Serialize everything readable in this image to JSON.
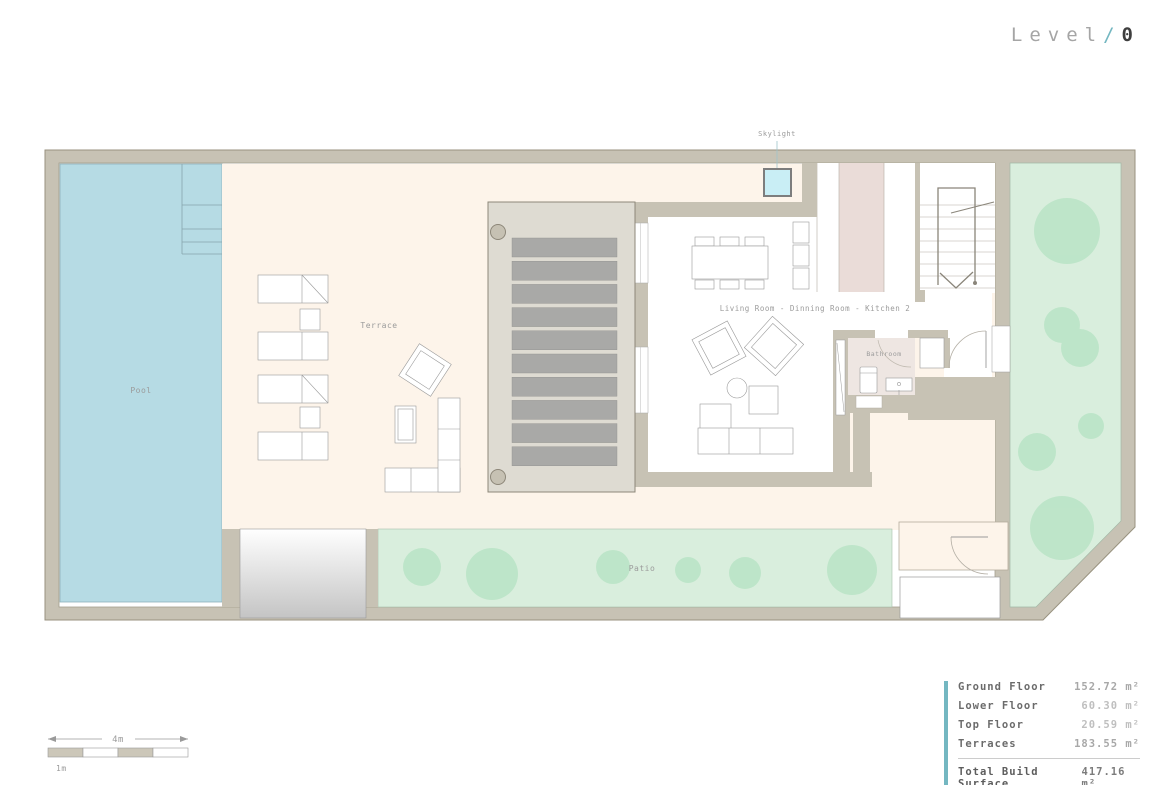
{
  "header": {
    "level_label": "Level",
    "separator": "/",
    "level_number": "0"
  },
  "plan": {
    "labels": {
      "skylight": "Skylight",
      "pool": "Pool",
      "terrace": "Terrace",
      "patio": "Patio",
      "bathroom": "Bathroom",
      "living_area": "Living Room - Dinning Room - Kitchen 2"
    }
  },
  "scale_bar": {
    "total_label": "4m",
    "unit_label": "1m"
  },
  "summary": {
    "rows": [
      {
        "label": "Ground Floor",
        "value": "152.72 m²"
      },
      {
        "label": "Lower Floor",
        "value": "60.30 m²"
      },
      {
        "label": "Top Floor",
        "value": "20.59 m²"
      },
      {
        "label": "Terraces",
        "value": "183.55 m²"
      }
    ],
    "total": {
      "label": "Total Build Surface",
      "value": "417.16 m²"
    }
  },
  "colors": {
    "accent_teal": "#74b7c1",
    "wall_tan": "#c7c2b4",
    "pool_blue": "#b6dbe4",
    "terrace_cream": "#fdf4ea",
    "garden_green": "#d9eedd",
    "tree_green": "#ace0bc",
    "kitchen_pink": "#eadcd8",
    "bathroom_pink": "#eee6e2",
    "skylight_cyan": "#c9eef5",
    "louver_gray": "#a9a9a7",
    "deck_gray": "#dedbd2"
  }
}
